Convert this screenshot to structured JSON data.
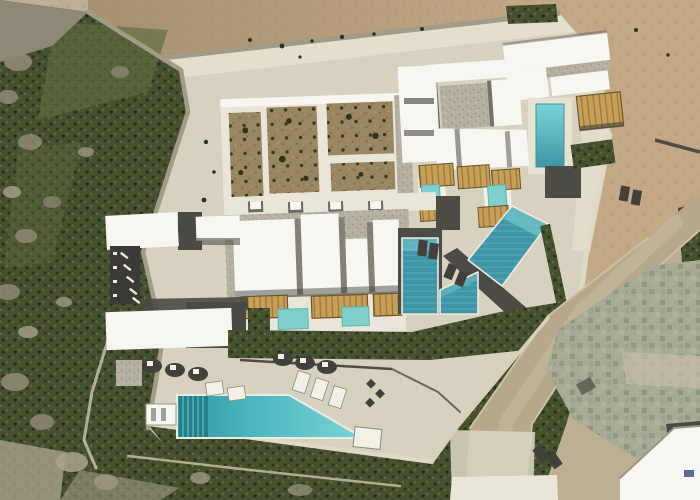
{
  "meta": {
    "type": "aerial-drone-photograph",
    "description": "Top-down aerial photograph of a white Cycladic-style hillside villa resort: flat white roofs with wooden pergolas, a walled kitchen garden, several turquoise pools including a long main infinity lap pool, sun loungers on pale concrete terraces, a rocky green hillside to the left, bare beige earth above and to the right, a dirt road and a stone patio with white cottages at lower right.",
    "visible_text": "none"
  },
  "colors": {
    "dirt_base": "#beae93",
    "dirt_field": "#a5906f",
    "dirt_tan": "#c2a885",
    "concrete": "#d7d1c0",
    "concrete_bright": "#e7e1d0",
    "hill": "#465130",
    "veg": "#3e4929",
    "veg_dark": "#2b341c",
    "veg_light": "#5e6c40",
    "rock": "#8f8876",
    "rock_light": "#aaa28c",
    "wall_light": "#e0d9c6",
    "wall_gravel": "#a19b88",
    "roof_white": "#f7f6f1",
    "roof_offwhite": "#e9e5d8",
    "roof_gravel": "#b5b0a1",
    "roof_dark": "#4a4944",
    "asphalt": "#3b3a36",
    "deck": "#4c4b45",
    "pergola_wood": "#c79f57",
    "pergola_beam": "#8a6b33",
    "pool_main_dark": "#2f98a3",
    "pool_main": "#49b5be",
    "pool_main_light": "#79d4d8",
    "pool_lane": "#257f89",
    "pool_tile": "#3f96a7",
    "pool_tile_light": "#74c4cc",
    "pool_plunge": "#7fd0cb",
    "pool_coping": "#ecebe0",
    "patio_stone": "#a7ab95",
    "patio_light": "#c3bca5",
    "road_dirt": "#b7a88c",
    "road_light": "#cabc9f",
    "soil": "#9a8660",
    "shadow": "#3f3e3a",
    "furniture_white": "#f2f0e7",
    "lounger_dark": "#42403b"
  },
  "scene": {
    "terrain": [
      "rocky green hillside (west)",
      "bare brown earth field (north)",
      "tan dirt (east)",
      "pale concrete terraces (center)",
      "dirt road (southeast)",
      "stone patio (southeast corner)"
    ],
    "features": [
      {
        "name": "walled-kitchen-garden",
        "desc": "white-walled enclosure with earth planting beds and shrubs"
      },
      {
        "name": "north-villa",
        "desc": "large white flat-roofed villa with gravel roof borders, plunge pool and pergola"
      },
      {
        "name": "mid-villa-row",
        "desc": "stepped guest units with pergolas and two plunge pools"
      },
      {
        "name": "main-villa-block",
        "desc": "row of four white roof volumes over a pergola-shaded terrace with two plunge pools"
      },
      {
        "name": "pool-courtyard",
        "desc": "dark timber deck with an L-shaped tiled pool and a diagonal lap pool"
      },
      {
        "name": "west-service-block",
        "desc": "white service buildings, courtyard and striped parking bays"
      },
      {
        "name": "main-infinity-pool",
        "desc": "long turquoise infinity lap pool with dark lane stripes at its west end"
      },
      {
        "name": "sun-terrace",
        "desc": "rows of dark shaded loungers, white daybeds and deck chairs"
      },
      {
        "name": "southeast-cottages",
        "desc": "white cottages beside a green-grey stone patio and dirt road"
      }
    ],
    "pool_count": 7,
    "pergola_count": 9
  }
}
